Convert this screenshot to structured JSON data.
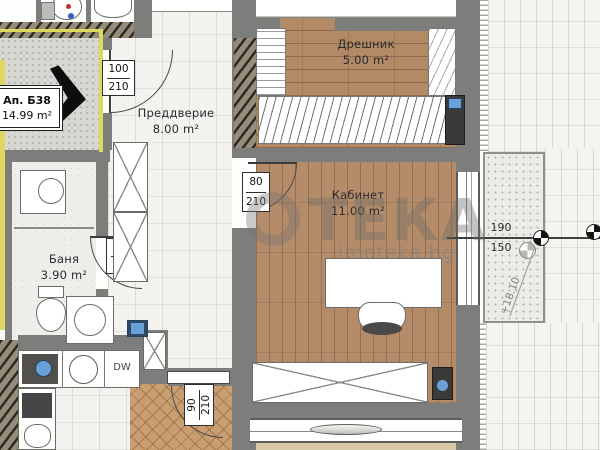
{
  "watermark": {
    "brand": "ТЕКА",
    "site": "imoteka.bg"
  },
  "apartment": {
    "id": "Ап. Б38",
    "area": "14.99 m²"
  },
  "rooms": {
    "vestibule": {
      "name": "Преддверие",
      "area": "8.00 m²"
    },
    "closet": {
      "name": "Дрешник",
      "area": "5.00 m²"
    },
    "office": {
      "name": "Кабинет",
      "area": "11.00 m²"
    },
    "bath": {
      "name": "Баня",
      "area": "3.90 m²"
    }
  },
  "doors": {
    "entry": {
      "w": "100",
      "h": "210"
    },
    "office": {
      "w": "80",
      "h": "210"
    },
    "bath": {
      "w": "80",
      "h": "210"
    },
    "hall": {
      "w": "90",
      "h": "210"
    }
  },
  "window_dim": {
    "w": "190",
    "h": "150"
  },
  "elevation": "+18.10",
  "kitchen": {
    "dishwasher": "DW"
  }
}
